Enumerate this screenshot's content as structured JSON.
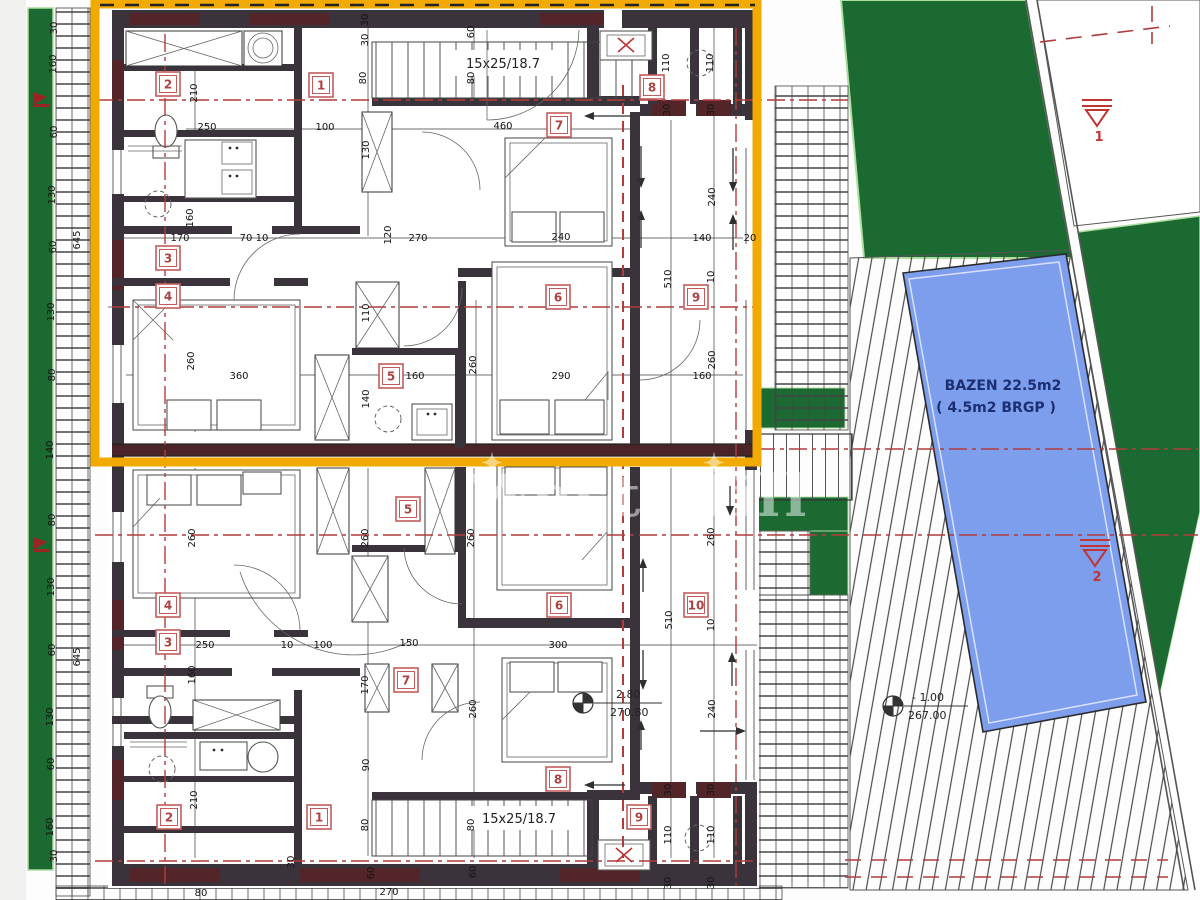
{
  "colors": {
    "highlight_yellow": "#f2a900",
    "site_green": "#1a6a31",
    "green_edge": "#aede9f",
    "pool_blue": "#7d9ded",
    "annotation_red": "#b13c3c",
    "wall_dark": "#3a333b",
    "wall_maroon": "#532529"
  },
  "watermark": {
    "text": "West Hill",
    "star": "✦"
  },
  "site": {
    "pool": {
      "label_line1": "BAZEN 22.5m2",
      "label_line2": "( 4.5m2 BRGP )"
    }
  },
  "stairs": {
    "top": "15x25/18.7",
    "bottom": "15x25/18.7"
  },
  "benchmarks": {
    "b1": "1",
    "b2": "2"
  },
  "elevations": {
    "interior": {
      "value": "2.80",
      "datum": "270.80"
    },
    "site": {
      "value": "- 1.00",
      "datum": "267.00"
    }
  },
  "rooms": {
    "upper": [
      {
        "n": "1",
        "x": 321,
        "y": 85
      },
      {
        "n": "2",
        "x": 168,
        "y": 84
      },
      {
        "n": "3",
        "x": 168,
        "y": 258
      },
      {
        "n": "4",
        "x": 168,
        "y": 296
      },
      {
        "n": "5",
        "x": 391,
        "y": 376
      },
      {
        "n": "6",
        "x": 558,
        "y": 297
      },
      {
        "n": "7",
        "x": 559,
        "y": 125
      },
      {
        "n": "8",
        "x": 652,
        "y": 87
      },
      {
        "n": "9",
        "x": 696,
        "y": 297
      }
    ],
    "lower": [
      {
        "n": "1",
        "x": 319,
        "y": 817
      },
      {
        "n": "2",
        "x": 169,
        "y": 817
      },
      {
        "n": "3",
        "x": 168,
        "y": 642
      },
      {
        "n": "4",
        "x": 168,
        "y": 605
      },
      {
        "n": "5",
        "x": 408,
        "y": 509
      },
      {
        "n": "6",
        "x": 559,
        "y": 605
      },
      {
        "n": "7",
        "x": 406,
        "y": 680
      },
      {
        "n": "8",
        "x": 558,
        "y": 779
      },
      {
        "n": "9",
        "x": 639,
        "y": 817
      },
      {
        "n": "10",
        "x": 696,
        "y": 605
      }
    ]
  },
  "dims": {
    "upper": [
      {
        "t": "30",
        "x": 368,
        "y": 20,
        "r": 1
      },
      {
        "t": "30",
        "x": 368,
        "y": 40,
        "r": 1
      },
      {
        "t": "80",
        "x": 366,
        "y": 78,
        "r": 1
      },
      {
        "t": "60",
        "x": 474,
        "y": 32,
        "r": 1
      },
      {
        "t": "80",
        "x": 474,
        "y": 78,
        "r": 1
      },
      {
        "t": "130",
        "x": 369,
        "y": 150,
        "r": 1
      },
      {
        "t": "460",
        "x": 503,
        "y": 129
      },
      {
        "t": "210",
        "x": 197,
        "y": 93,
        "r": 1
      },
      {
        "t": "250",
        "x": 207,
        "y": 130
      },
      {
        "t": "100",
        "x": 325,
        "y": 130
      },
      {
        "t": "160",
        "x": 193,
        "y": 218,
        "r": 1
      },
      {
        "t": "170",
        "x": 180,
        "y": 241
      },
      {
        "t": "70 10",
        "x": 254,
        "y": 241
      },
      {
        "t": "120",
        "x": 391,
        "y": 235,
        "r": 1
      },
      {
        "t": "270",
        "x": 418,
        "y": 241
      },
      {
        "t": "240",
        "x": 561,
        "y": 240
      },
      {
        "t": "140",
        "x": 702,
        "y": 241
      },
      {
        "t": "20",
        "x": 750,
        "y": 241
      },
      {
        "t": "110",
        "x": 669,
        "y": 63,
        "r": 1
      },
      {
        "t": "110",
        "x": 713,
        "y": 63,
        "r": 1
      },
      {
        "t": "30",
        "x": 670,
        "y": 110,
        "r": 1
      },
      {
        "t": "30",
        "x": 714,
        "y": 110,
        "r": 1
      },
      {
        "t": "240",
        "x": 715,
        "y": 197,
        "r": 1
      },
      {
        "t": "10",
        "x": 714,
        "y": 277,
        "r": 1
      },
      {
        "t": "510",
        "x": 671,
        "y": 279,
        "r": 1
      },
      {
        "t": "260",
        "x": 194,
        "y": 361,
        "r": 1
      },
      {
        "t": "360",
        "x": 239,
        "y": 379
      },
      {
        "t": "110",
        "x": 369,
        "y": 313,
        "r": 1
      },
      {
        "t": "140",
        "x": 369,
        "y": 399,
        "r": 1
      },
      {
        "t": "160",
        "x": 415,
        "y": 379
      },
      {
        "t": "260",
        "x": 476,
        "y": 365,
        "r": 1
      },
      {
        "t": "290",
        "x": 561,
        "y": 379
      },
      {
        "t": "160",
        "x": 702,
        "y": 379
      },
      {
        "t": "260",
        "x": 715,
        "y": 360,
        "r": 1
      }
    ],
    "lower": [
      {
        "t": "260",
        "x": 195,
        "y": 538,
        "r": 1
      },
      {
        "t": "260",
        "x": 368,
        "y": 538,
        "r": 1
      },
      {
        "t": "260",
        "x": 474,
        "y": 538,
        "r": 1
      },
      {
        "t": "260",
        "x": 714,
        "y": 537,
        "r": 1
      },
      {
        "t": "510",
        "x": 672,
        "y": 620,
        "r": 1
      },
      {
        "t": "10",
        "x": 714,
        "y": 625,
        "r": 1
      },
      {
        "t": "250",
        "x": 205,
        "y": 648
      },
      {
        "t": "10",
        "x": 287,
        "y": 648
      },
      {
        "t": "100",
        "x": 323,
        "y": 648
      },
      {
        "t": "150",
        "x": 409,
        "y": 646
      },
      {
        "t": "170",
        "x": 368,
        "y": 685,
        "r": 1
      },
      {
        "t": "160",
        "x": 195,
        "y": 675,
        "r": 1
      },
      {
        "t": "300",
        "x": 558,
        "y": 648
      },
      {
        "t": "90",
        "x": 369,
        "y": 765,
        "r": 1
      },
      {
        "t": "240",
        "x": 715,
        "y": 709,
        "r": 1
      },
      {
        "t": "260",
        "x": 476,
        "y": 709,
        "r": 1
      },
      {
        "t": "210",
        "x": 197,
        "y": 800,
        "r": 1
      },
      {
        "t": "80",
        "x": 368,
        "y": 825,
        "r": 1
      },
      {
        "t": "80",
        "x": 474,
        "y": 825,
        "r": 1
      },
      {
        "t": "110",
        "x": 671,
        "y": 835,
        "r": 1
      },
      {
        "t": "110",
        "x": 714,
        "y": 835,
        "r": 1
      },
      {
        "t": "60",
        "x": 476,
        "y": 872,
        "r": 1
      },
      {
        "t": "30",
        "x": 671,
        "y": 790,
        "r": 1
      },
      {
        "t": "30",
        "x": 714,
        "y": 790,
        "r": 1
      },
      {
        "t": "30",
        "x": 671,
        "y": 883,
        "r": 1
      },
      {
        "t": "30",
        "x": 714,
        "y": 883,
        "r": 1
      }
    ],
    "left": [
      {
        "t": "30",
        "x": 57,
        "y": 28,
        "r": 1
      },
      {
        "t": "160",
        "x": 56,
        "y": 64,
        "r": 1
      },
      {
        "t": "60",
        "x": 57,
        "y": 132,
        "r": 1
      },
      {
        "t": "130",
        "x": 55,
        "y": 195,
        "r": 1
      },
      {
        "t": "60",
        "x": 56,
        "y": 247,
        "r": 1
      },
      {
        "t": "130",
        "x": 54,
        "y": 312,
        "r": 1
      },
      {
        "t": "80",
        "x": 55,
        "y": 375,
        "r": 1
      },
      {
        "t": "140",
        "x": 53,
        "y": 450,
        "r": 1
      },
      {
        "t": "80",
        "x": 55,
        "y": 520,
        "r": 1
      },
      {
        "t": "130",
        "x": 54,
        "y": 587,
        "r": 1
      },
      {
        "t": "60",
        "x": 55,
        "y": 650,
        "r": 1
      },
      {
        "t": "130",
        "x": 53,
        "y": 717,
        "r": 1
      },
      {
        "t": "60",
        "x": 54,
        "y": 764,
        "r": 1
      },
      {
        "t": "160",
        "x": 53,
        "y": 827,
        "r": 1
      },
      {
        "t": "30",
        "x": 57,
        "y": 856,
        "r": 1
      },
      {
        "t": "645",
        "x": 80,
        "y": 240,
        "r": 1
      },
      {
        "t": "645",
        "x": 80,
        "y": 657,
        "r": 1
      }
    ],
    "bottom": [
      {
        "t": "30",
        "x": 294,
        "y": 862,
        "r": 1
      },
      {
        "t": "60",
        "x": 374,
        "y": 873,
        "r": 1
      },
      {
        "t": "270",
        "x": 389,
        "y": 895
      },
      {
        "t": "80",
        "x": 201,
        "y": 896
      }
    ]
  }
}
